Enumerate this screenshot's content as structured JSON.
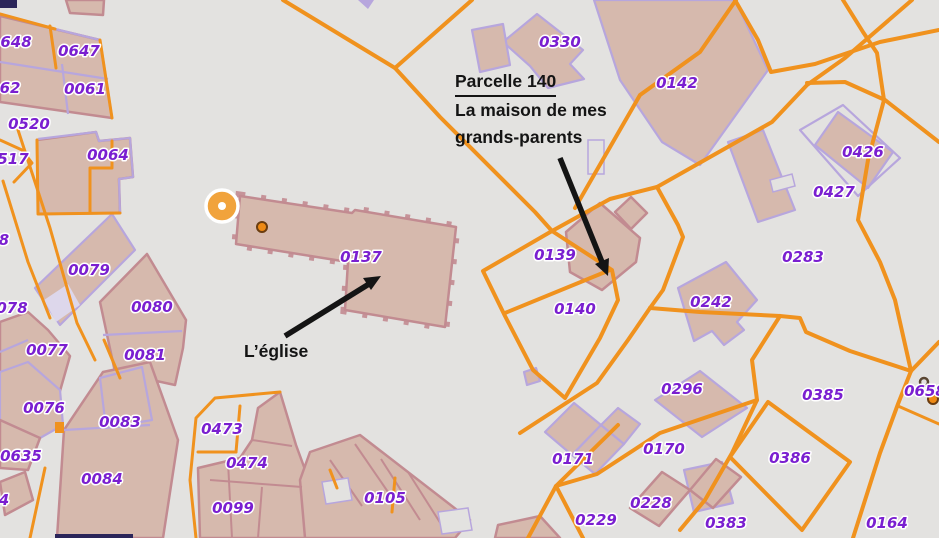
{
  "annotations": {
    "parcel_note": {
      "title": "Parcelle 140",
      "line1": "La maison de mes",
      "line2": "grands-parents"
    },
    "church_note": {
      "label": "L’église"
    }
  },
  "parcel_labels": [
    {
      "t": "648",
      "x": 16,
      "y": 47
    },
    {
      "t": "0647",
      "x": 79,
      "y": 56
    },
    {
      "t": "62",
      "x": 10,
      "y": 93
    },
    {
      "t": "0061",
      "x": 85,
      "y": 94
    },
    {
      "t": "0520",
      "x": 29,
      "y": 129
    },
    {
      "t": "517",
      "x": 13,
      "y": 164
    },
    {
      "t": "0064",
      "x": 108,
      "y": 160
    },
    {
      "t": "0330",
      "x": 560,
      "y": 47
    },
    {
      "t": "0142",
      "x": 677,
      "y": 88
    },
    {
      "t": "0426",
      "x": 863,
      "y": 157
    },
    {
      "t": "0427",
      "x": 834,
      "y": 197
    },
    {
      "t": "0283",
      "x": 803,
      "y": 262
    },
    {
      "t": "0137",
      "x": 361,
      "y": 262
    },
    {
      "t": "0139",
      "x": 555,
      "y": 260
    },
    {
      "t": "0140",
      "x": 575,
      "y": 314
    },
    {
      "t": "0079",
      "x": 89,
      "y": 275
    },
    {
      "t": "8",
      "x": 4,
      "y": 245
    },
    {
      "t": "078",
      "x": 12,
      "y": 313
    },
    {
      "t": "0080",
      "x": 152,
      "y": 312
    },
    {
      "t": "0077",
      "x": 47,
      "y": 355
    },
    {
      "t": "0081",
      "x": 145,
      "y": 360
    },
    {
      "t": "0242",
      "x": 711,
      "y": 307
    },
    {
      "t": "0296",
      "x": 682,
      "y": 394
    },
    {
      "t": "0385",
      "x": 823,
      "y": 400
    },
    {
      "t": "0658",
      "x": 925,
      "y": 396
    },
    {
      "t": "0171",
      "x": 573,
      "y": 464
    },
    {
      "t": "0170",
      "x": 664,
      "y": 454
    },
    {
      "t": "0228",
      "x": 651,
      "y": 508
    },
    {
      "t": "0229",
      "x": 596,
      "y": 525
    },
    {
      "t": "0383",
      "x": 726,
      "y": 528
    },
    {
      "t": "0386",
      "x": 790,
      "y": 463
    },
    {
      "t": "0164",
      "x": 887,
      "y": 528
    },
    {
      "t": "0473",
      "x": 222,
      "y": 434
    },
    {
      "t": "0474",
      "x": 247,
      "y": 468
    },
    {
      "t": "0099",
      "x": 233,
      "y": 513
    },
    {
      "t": "0105",
      "x": 385,
      "y": 503
    },
    {
      "t": "0076",
      "x": 44,
      "y": 413
    },
    {
      "t": "0083",
      "x": 120,
      "y": 427
    },
    {
      "t": "0635",
      "x": 21,
      "y": 461
    },
    {
      "t": "0084",
      "x": 102,
      "y": 484
    },
    {
      "t": "4",
      "x": 4,
      "y": 505
    }
  ],
  "symbols": {
    "church_point": "church-point-symbol",
    "church_tower_dot": "tower-dot",
    "utility_dot_0658": "utility-dot",
    "hydrant_square": "small-orange-marker"
  },
  "colors": {
    "background": "#e3e2e0",
    "road_orange": "#f0921e",
    "building_fill": "#d6b9ad",
    "building_stroke": "#c28b91",
    "parcel_purple": "#b7a6dd",
    "label_purple": "#7a1fd0",
    "annotation_black": "#141414",
    "church_symbol_orange": "#f1a33c",
    "navy_fragment": "#2b2559",
    "lavender_fill": "#ddd7eb"
  }
}
